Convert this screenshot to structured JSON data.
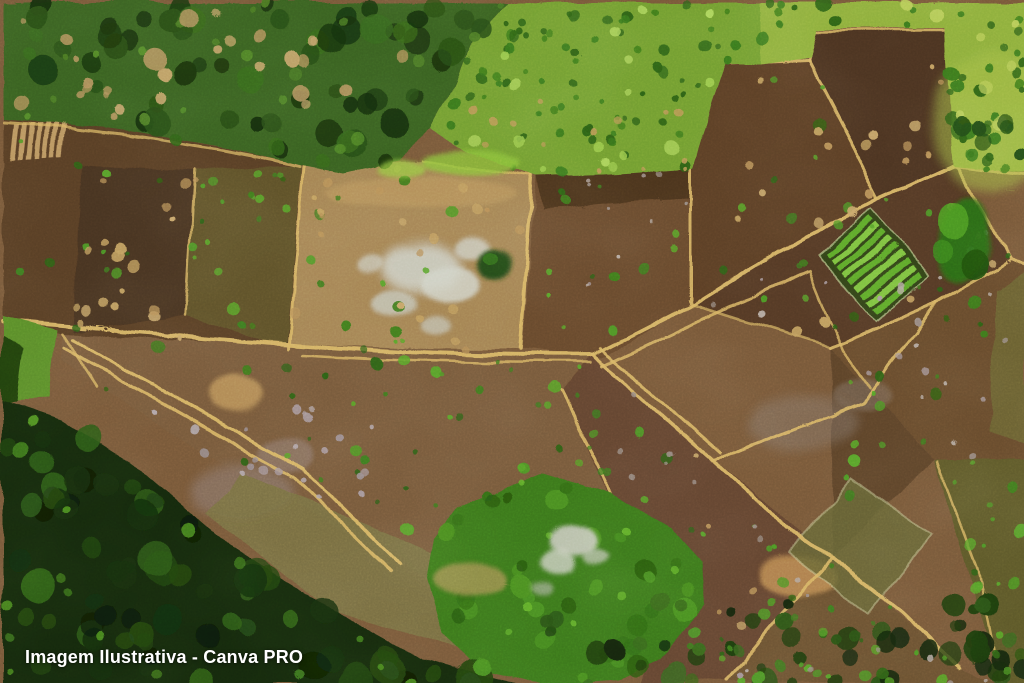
{
  "meta": {
    "type": "aerial-drone-photograph",
    "subject": "Top-down drone view of a patchwork of cleared farm plots (rice-paddy style fields) divided by light tan earthen bunds, surrounded by tropical palm forest and bright grassland",
    "width_px": 1024,
    "height_px": 683
  },
  "watermark": {
    "text": "Imagem Ilustrativa - Canva PRO",
    "color": "#ffffff",
    "position": "bottom-left",
    "font_weight": "bold"
  },
  "palette": {
    "palm_forest_base": "#3a6320",
    "palm_crown_dark": "#2a4f16",
    "meadow_green": "#74a033",
    "grass_right": "#90b03e",
    "forest_shadow": "#182b10",
    "veg_bottom": "#3c7a1c",
    "plot_brown_dark": "#4e3520",
    "plot_brown": "#6a4c2e",
    "plot_brown_light": "#7a5c3c",
    "plot_tan_wet": "#a68655",
    "bund_tan": "#d9b767",
    "waterlogged_white": "#cdcfc4",
    "seedbed_green": "#5faa2c",
    "seedbed_tan": "#c6a36a",
    "bush_green": "#3f7d1f",
    "olive_field": "#7b7444",
    "base_brown": "#7a5a3a"
  },
  "regions": [
    {
      "name": "palm-forest-top-left",
      "description": "Dense palm canopy with sandy tan gaps",
      "color": "#3a6320"
    },
    {
      "name": "grass-meadow-top-center",
      "description": "Bright grassland speckled with dark shrubs",
      "color": "#74a033"
    },
    {
      "name": "grassland-top-right",
      "description": "Yellow-green grass strip in the top right corner",
      "color": "#90b03e"
    },
    {
      "name": "farm-plot-band",
      "description": "Diagonal band of brown cleared plots separated by tan bunds",
      "color": "#6a4c2e"
    },
    {
      "name": "waterlogged-plot",
      "description": "Pale flooded/white patch inside a tan plot left of center",
      "color": "#cdcfc4"
    },
    {
      "name": "seedbed-stripes-top-left",
      "description": "Small striped seedbed plot at upper left",
      "color": "#c6a36a"
    },
    {
      "name": "seedbed-stripes-right",
      "description": "Bright green striped seedling beds at middle right",
      "color": "#5faa2c"
    },
    {
      "name": "tree-cluster-right",
      "description": "Isolated bushy tree clump among the right plots",
      "color": "#2f7015"
    },
    {
      "name": "forest-bottom-left",
      "description": "Very dark dense forest canopy along lower left and bottom",
      "color": "#182b10"
    },
    {
      "name": "vegetation-bottom-center",
      "description": "Bushy green regrowth with small pale rocky patch",
      "color": "#3c7a1c"
    },
    {
      "name": "bunds-and-paths",
      "description": "Light tan earthen bunds and double-track paths dividing plots",
      "color": "#d9b767"
    }
  ]
}
